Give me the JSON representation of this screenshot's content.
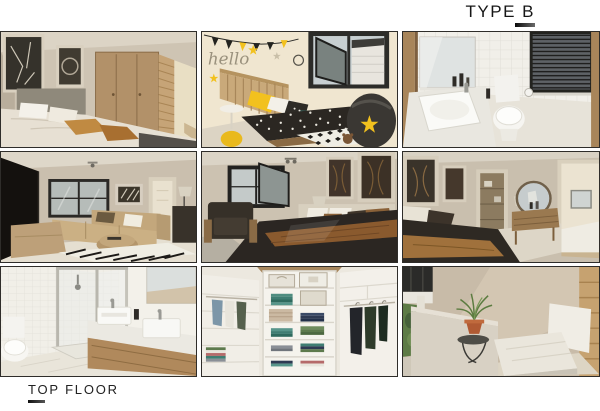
{
  "page": {
    "background": "#ffffff",
    "accent": "#1a1a1a",
    "frame_border": "#2f2d2a"
  },
  "header": {
    "title": "TYPE B"
  },
  "footer": {
    "label": "TOP FLOOR"
  },
  "gallery": {
    "layout": "3x3-render-grid",
    "items": [
      {
        "id": "bedroom-wardrobe",
        "alt": "Bedroom render with wooden wardrobe, framed wall art and double bed"
      },
      {
        "id": "kids-bedroom",
        "alt": "Kids bedroom render with hello wall decal, yellow stars, polka-dot bedding and bean bag",
        "wall_text": "hello"
      },
      {
        "id": "bathroom-guest",
        "alt": "Tiled bathroom render with basin, toilet and window blinds"
      },
      {
        "id": "living-room",
        "alt": "Lounge render with corner couch, round ottoman, zebra rug and TV"
      },
      {
        "id": "main-bedroom",
        "alt": "Main bedroom render with double bed, armchair, window and framed artwork"
      },
      {
        "id": "bedroom-dresser",
        "alt": "Bedroom render with dressing table, round mirror and walk-through to en-suite"
      },
      {
        "id": "bathroom-double-vanity",
        "alt": "Bathroom render with corner shower, toilet and double basin vanity"
      },
      {
        "id": "walk-in-closet",
        "alt": "Walk-in closet render with white shelving, folded clothes and hanging rails"
      },
      {
        "id": "balcony-seat",
        "alt": "Balcony corner render with white lounger, side table and potted plant"
      }
    ]
  }
}
